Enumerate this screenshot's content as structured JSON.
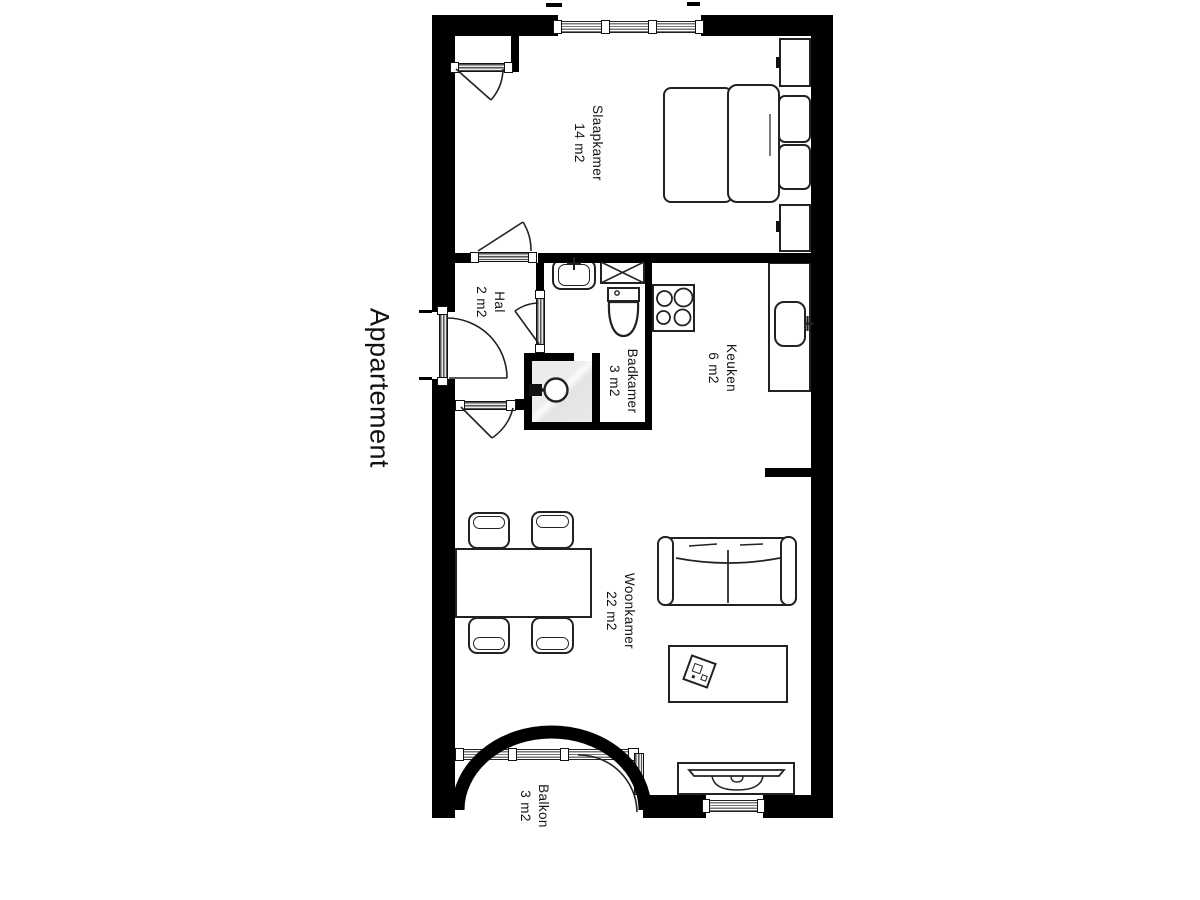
{
  "title": "Appartement",
  "rooms": [
    {
      "name": "Slaapkamer",
      "area": "14 m2"
    },
    {
      "name": "Hal",
      "area": "2 m2"
    },
    {
      "name": "Badkamer",
      "area": "3 m2"
    },
    {
      "name": "Keuken",
      "area": "6 m2"
    },
    {
      "name": "Woonkamer",
      "area": "22 m2"
    },
    {
      "name": "Balkon",
      "area": "3 m2"
    }
  ],
  "colors": {
    "wall": "#000000",
    "line": "#222222",
    "door_leaf": "#9a9a9a",
    "shower_shade": "#e9e9e9",
    "background": "#ffffff"
  },
  "furniture_icons": [
    "double-bed",
    "pillow",
    "nightstand",
    "closet-door",
    "wash-basin",
    "washing-machine",
    "toilet",
    "shower-head",
    "stove-4-burners",
    "kitchen-counter",
    "kitchen-sink",
    "dining-table",
    "chair",
    "sofa",
    "coffee-table",
    "decor-tray",
    "tv-cabinet"
  ]
}
